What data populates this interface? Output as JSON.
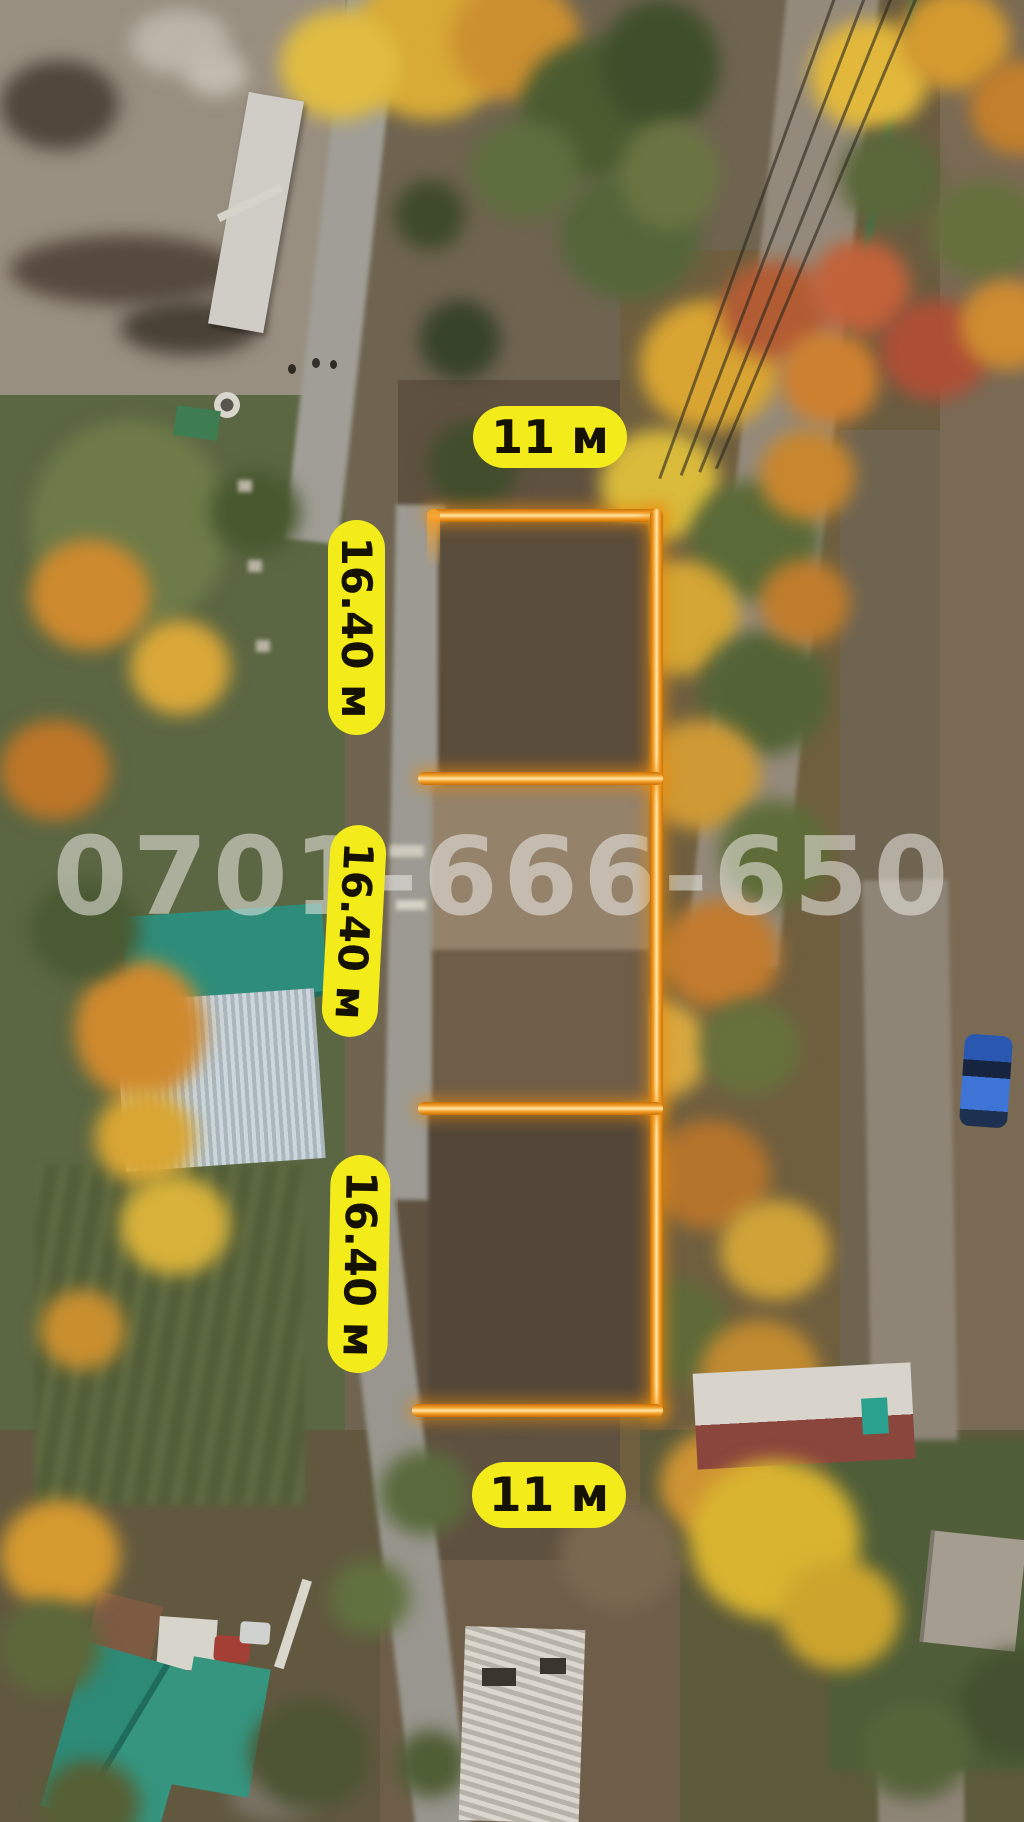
{
  "annotations": {
    "watermark_phone": "0701-666-650",
    "top_width_label": "11 м",
    "bottom_width_label": "11 м",
    "side_length_labels": [
      "16.40 м",
      "16.40 м",
      "16.40 м"
    ],
    "plot_sections": 3
  },
  "colors": {
    "label_background": "#f3ec1a",
    "label_text": "#151103",
    "plot_outline_orange": "#ef9211",
    "outline_glow": "rgba(235,140,12,0.55)",
    "watermark_text": "rgba(236,235,229,0.55)"
  },
  "scene": {
    "features": [
      "autumn-aerial-photo",
      "gravel-road-left",
      "gravel-road-right",
      "cleared-dirt-plot",
      "autumn-trees",
      "teal-roof-house-left",
      "white-red-roof-house-right",
      "blue-car",
      "garden-beds",
      "teal-roof-sheds-bottom-left",
      "house-under-construction-bottom",
      "power-lines-top-right",
      "rock-pile-top-left",
      "well-circle"
    ]
  }
}
